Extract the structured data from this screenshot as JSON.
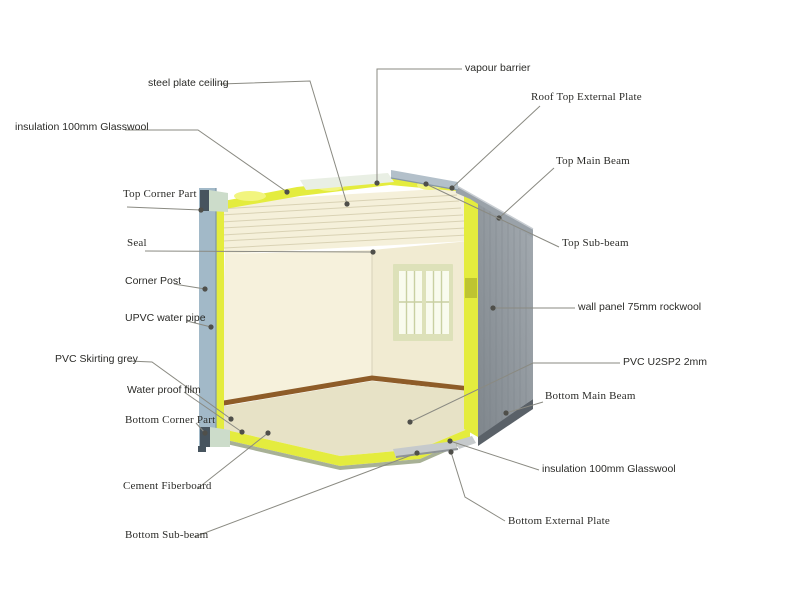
{
  "colors": {
    "background": "#ffffff",
    "leader_line": "#8a8a82",
    "dot": "#4f4f4a",
    "label_text": "#2b2b28",
    "post_blue": "#a2b9c8",
    "post_edge": "#7e97a8",
    "post_dark": "#47545e",
    "post_cap_green": "#ccdcca",
    "insulation_yellow": "#e4ec3e",
    "insulation_light": "#f2f57f",
    "insulation_olive": "#b7bd2e",
    "ceiling_cream": "#f5f0da",
    "ceiling_line": "#d9d2b4",
    "wall_left_cream": "#f6f1dc",
    "wall_right_cream": "#f1ebd2",
    "wall_corner_line": "#ddd6bd",
    "floor_beige": "#e7e2c6",
    "floor_edge_green": "#a8b196",
    "skirting_brown": "#8e5c28",
    "ext_wall_gray_top": "#9aa1a7",
    "ext_wall_gray_bottom": "#848b91",
    "ext_wall_rib": "#767d84",
    "roof_band_gray": "#9aa2a9",
    "roof_band_highlight": "#c9ced3",
    "roof_plate_gray": "#b3c0ca",
    "roof_plate_edge": "#8798a4",
    "vapour_sheet": "#e9efe4",
    "bottom_plate_gray": "#c6cacc",
    "bottom_plate_edge": "#8f9497",
    "bottom_beam_dark": "#5a6168",
    "window_frame": "#dde1b9",
    "window_pane": "#f9fbee",
    "window_muntin": "#c9d0a2"
  },
  "diagram": {
    "labels": [
      {
        "id": "steel-plate-ceiling",
        "text": "steel plate ceiling",
        "font": "sans",
        "x": 148,
        "y": 77,
        "line": [
          [
            220,
            84
          ],
          [
            310,
            81
          ],
          [
            347,
            204
          ]
        ],
        "dot": [
          347,
          204
        ]
      },
      {
        "id": "vapour-barrier",
        "text": "vapour barrier",
        "font": "sans",
        "x": 465,
        "y": 62,
        "line": [
          [
            462,
            69
          ],
          [
            377,
            69
          ],
          [
            377,
            183
          ]
        ],
        "dot": [
          377,
          183
        ]
      },
      {
        "id": "roof-top-external-plate",
        "text": "Roof Top External Plate",
        "font": "serif",
        "x": 531,
        "y": 91,
        "line": [
          [
            540,
            106
          ],
          [
            452,
            188
          ]
        ],
        "dot": [
          452,
          188
        ]
      },
      {
        "id": "insulation-glasswool-left",
        "text": "insulation 100mm Glasswool",
        "font": "sans",
        "x": 15,
        "y": 121,
        "line": [
          [
            125,
            130
          ],
          [
            198,
            130
          ],
          [
            287,
            192
          ]
        ],
        "dot": [
          287,
          192
        ]
      },
      {
        "id": "top-main-beam",
        "text": "Top Main Beam",
        "font": "serif",
        "x": 556,
        "y": 155,
        "line": [
          [
            554,
            168
          ],
          [
            499,
            218
          ]
        ],
        "dot": [
          499,
          218
        ]
      },
      {
        "id": "top-corner-part",
        "text": "Top Corner Part",
        "font": "serif",
        "x": 123,
        "y": 188,
        "line": [
          [
            127,
            207
          ],
          [
            201,
            210
          ]
        ],
        "dot": [
          201,
          210
        ]
      },
      {
        "id": "top-sub-beam",
        "text": "Top Sub-beam",
        "font": "serif",
        "x": 562,
        "y": 237,
        "line": [
          [
            559,
            247
          ],
          [
            426,
            184
          ]
        ],
        "dot": [
          426,
          184
        ]
      },
      {
        "id": "seal",
        "text": "Seal",
        "font": "serif",
        "x": 127,
        "y": 237,
        "line": [
          [
            145,
            251
          ],
          [
            373,
            252
          ]
        ],
        "dot": [
          373,
          252
        ]
      },
      {
        "id": "corner-post",
        "text": "Corner Post",
        "font": "sans",
        "x": 125,
        "y": 275,
        "line": [
          [
            174,
            284
          ],
          [
            205,
            289
          ]
        ],
        "dot": [
          205,
          289
        ]
      },
      {
        "id": "wall-panel-rockwool",
        "text": "wall panel 75mm rockwool",
        "font": "sans",
        "x": 578,
        "y": 301,
        "line": [
          [
            575,
            308
          ],
          [
            493,
            308
          ]
        ],
        "dot": [
          493,
          308
        ]
      },
      {
        "id": "upvc-water-pipe",
        "text": "UPVC water pipe",
        "font": "sans",
        "x": 125,
        "y": 312,
        "line": [
          [
            187,
            321
          ],
          [
            211,
            327
          ]
        ],
        "dot": [
          211,
          327
        ]
      },
      {
        "id": "pvc-skirting-grey",
        "text": "PVC Skirting grey",
        "font": "sans",
        "x": 55,
        "y": 353,
        "line": [
          [
            128,
            361
          ],
          [
            152,
            362
          ],
          [
            231,
            419
          ]
        ],
        "dot": [
          231,
          419
        ]
      },
      {
        "id": "pvc-u2sp2",
        "text": "PVC U2SP2 2mm",
        "font": "sans",
        "x": 623,
        "y": 356,
        "line": [
          [
            620,
            363
          ],
          [
            533,
            363
          ],
          [
            410,
            422
          ]
        ],
        "dot": [
          410,
          422
        ]
      },
      {
        "id": "water-proof-film",
        "text": "Water proof film",
        "font": "sans",
        "x": 127,
        "y": 384,
        "line": [
          [
            184,
            392
          ],
          [
            242,
            432
          ]
        ],
        "dot": [
          242,
          432
        ]
      },
      {
        "id": "bottom-main-beam",
        "text": "Bottom Main Beam",
        "font": "serif",
        "x": 545,
        "y": 390,
        "line": [
          [
            543,
            402
          ],
          [
            506,
            413
          ]
        ],
        "dot": [
          506,
          413
        ]
      },
      {
        "id": "bottom-corner-part",
        "text": "Bottom Corner Part",
        "font": "serif",
        "x": 125,
        "y": 414,
        "line": [
          [
            196,
            423
          ],
          [
            205,
            433
          ]
        ],
        "dot": [
          205,
          433
        ]
      },
      {
        "id": "insulation-glasswool-right",
        "text": "insulation 100mm Glasswool",
        "font": "sans",
        "x": 542,
        "y": 463,
        "line": [
          [
            539,
            470
          ],
          [
            450,
            441
          ]
        ],
        "dot": [
          450,
          441
        ]
      },
      {
        "id": "cement-fiberboard",
        "text": "Cement Fiberboard",
        "font": "serif",
        "x": 123,
        "y": 480,
        "line": [
          [
            197,
            489
          ],
          [
            268,
            433
          ]
        ],
        "dot": [
          268,
          433
        ]
      },
      {
        "id": "bottom-external-plate",
        "text": "Bottom External Plate",
        "font": "serif",
        "x": 508,
        "y": 515,
        "line": [
          [
            505,
            521
          ],
          [
            465,
            497
          ],
          [
            451,
            452
          ]
        ],
        "dot": [
          451,
          452
        ]
      },
      {
        "id": "bottom-sub-beam",
        "text": "Bottom Sub-beam",
        "font": "serif",
        "x": 125,
        "y": 529,
        "line": [
          [
            194,
            537
          ],
          [
            417,
            453
          ]
        ],
        "dot": [
          417,
          453
        ]
      }
    ]
  }
}
